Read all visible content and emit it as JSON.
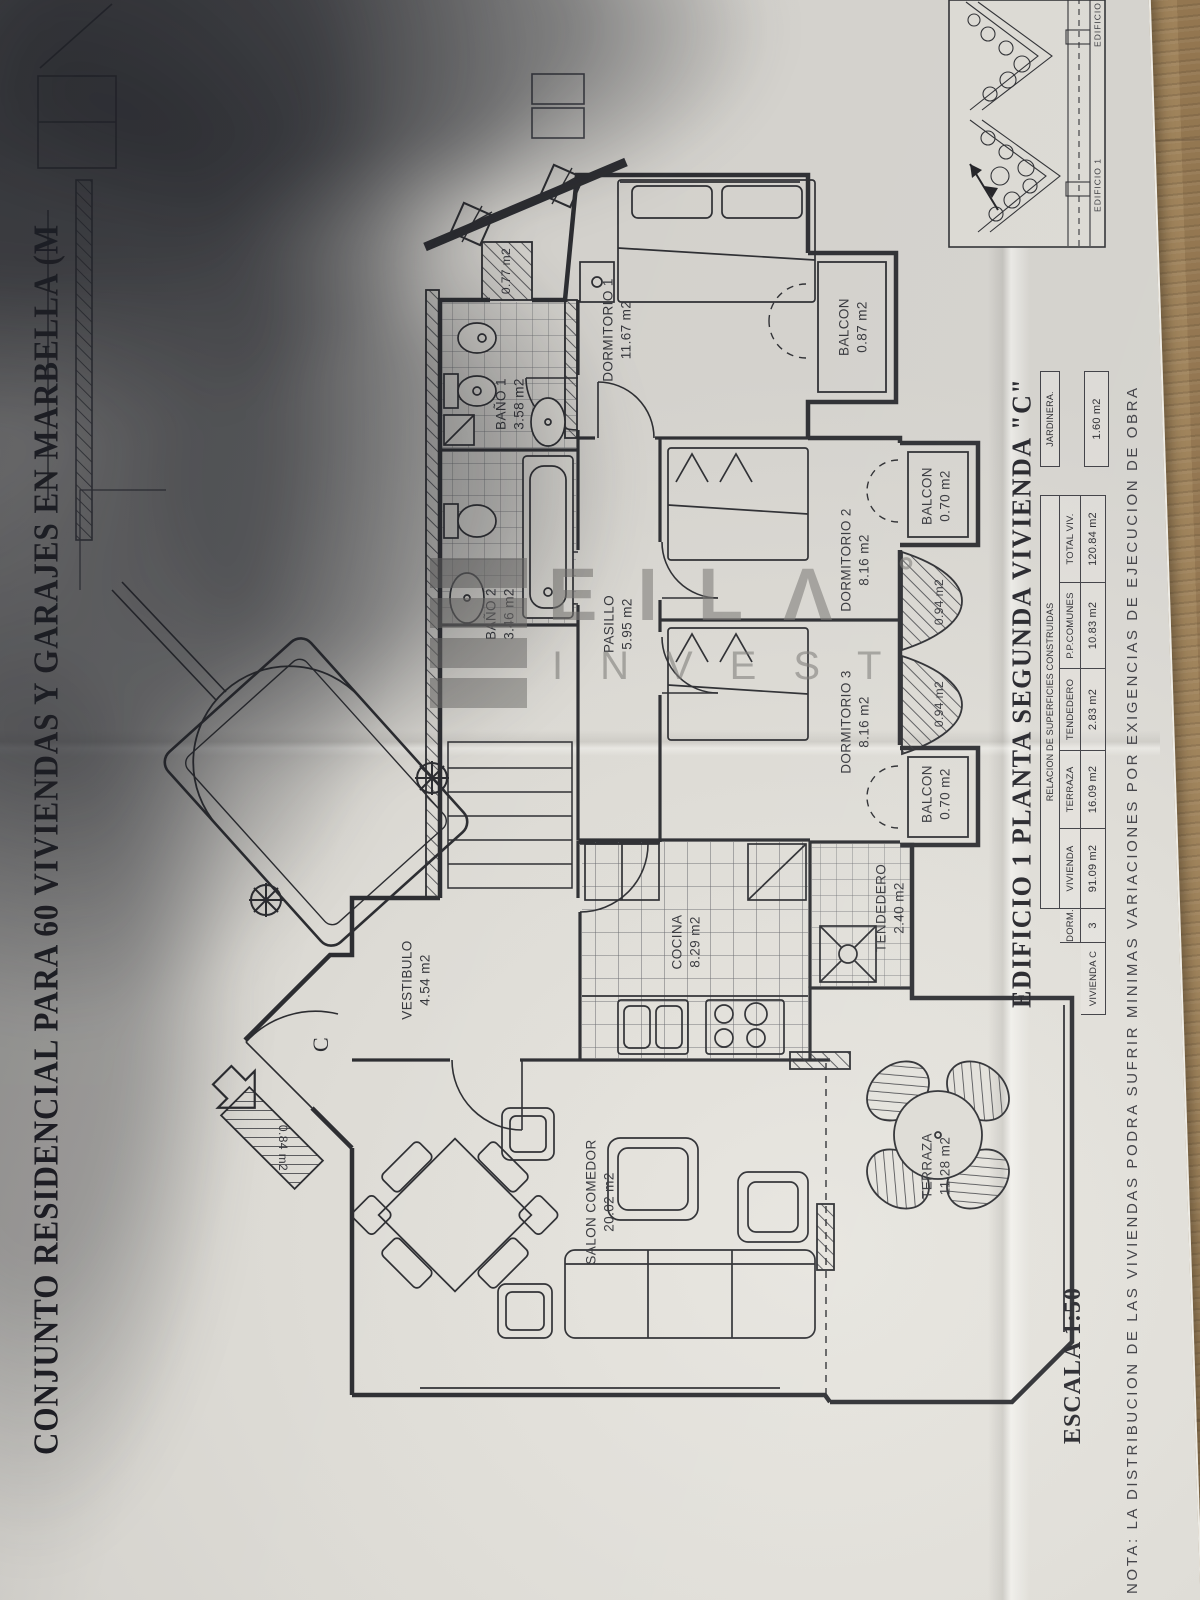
{
  "document": {
    "title": "CONJUNTO RESIDENCIAL PARA 60 VIVIENDAS Y GARAJES EN MARBELLA (M",
    "plan_title": "EDIFICIO 1  PLANTA SEGUNDA  VIVIENDA  \"C\"",
    "scale": "ESCALA 1:50",
    "note": "NOTA: LA DISTRIBUCION DE LAS VIVIENDAS PODRA SUFRIR MINIMAS VARIACIONES POR EXIGENCIAS DE EJECUCION DE OBRA",
    "entry_label": "C"
  },
  "rooms": [
    {
      "name": "DORMITORIO 1",
      "area": "11.67 m2"
    },
    {
      "name": "BALCON",
      "area": "0.87 m2"
    },
    {
      "name": "DORMITORIO 2",
      "area": "8.16 m2"
    },
    {
      "name": "BALCON",
      "area": "0.70 m2"
    },
    {
      "name": "DORMITORIO 3",
      "area": "8.16 m2"
    },
    {
      "name": "BALCON",
      "area": "0.70 m2"
    },
    {
      "name": "BAÑO 1",
      "area": "3.58 m2"
    },
    {
      "name": "BAÑO 2",
      "area": "3.46 m2"
    },
    {
      "name": "PASILLO",
      "area": "5.95 m2"
    },
    {
      "name": "VESTIBULO",
      "area": "4.54 m2"
    },
    {
      "name": "COCINA",
      "area": "8.29 m2"
    },
    {
      "name": "TENDEDERO",
      "area": "2.40 m2"
    },
    {
      "name": "SALON COMEDOR",
      "area": "20.02 m2"
    },
    {
      "name": "TERRAZA",
      "area": "11.28 m2"
    },
    {
      "name": "",
      "area": "0.77 m2"
    },
    {
      "name": "",
      "area": "0.94 m2"
    },
    {
      "name": "",
      "area": "0.94 m2"
    },
    {
      "name": "",
      "area": "0.84 m2"
    }
  ],
  "table": {
    "header": "RELACION DE SUPERFICIES CONSTRUIDAS",
    "row_label": "VIVIENDA C",
    "columns": [
      "DORM.",
      "VIVIENDA",
      "TERRAZA",
      "TENDEDERO",
      "P.P.COMUNES",
      "TOTAL VIV."
    ],
    "values": [
      "3",
      "91.09 m2",
      "16.09 m2",
      "2.83 m2",
      "10.83 m2",
      "120.84 m2"
    ],
    "jardinera_label": "JARDINERA.",
    "jardinera_value": "1.60 m2"
  },
  "site_map": {
    "edificio_1": "EDIFICIO 1",
    "edificio_2": "EDIFICIO 2"
  },
  "watermark": {
    "brand": "EILΛ",
    "degree": "°",
    "sub": "INVEST"
  },
  "colors": {
    "ink": "#2c2d31",
    "paper": "#d6d4cf",
    "wood": "#94764d",
    "watermark_gray": "#7a7975"
  }
}
